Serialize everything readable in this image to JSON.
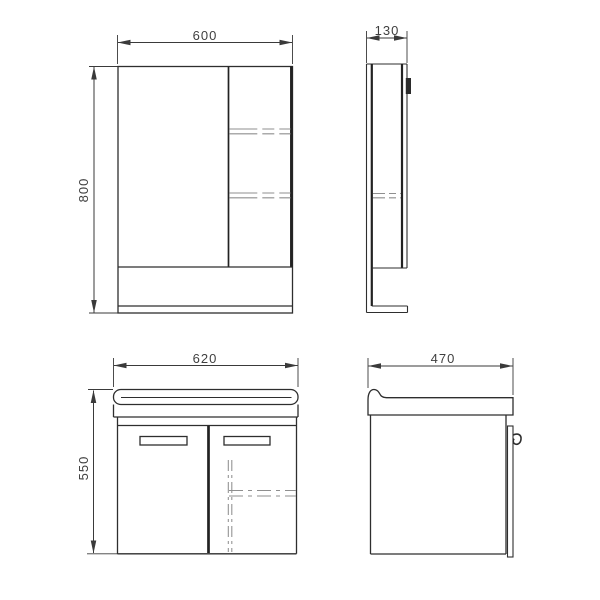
{
  "drawing": {
    "type": "technical-dimension-drawing",
    "units": "mm",
    "colors": {
      "line": "#2e2e2e",
      "hidden_line": "#8f8f8f",
      "dimension": "#3f3f3f",
      "background": "#ffffff"
    },
    "views": {
      "mirror_front": {
        "width_label": "600",
        "height_label": "800"
      },
      "mirror_side": {
        "depth_label": "130"
      },
      "vanity_front": {
        "width_label": "620",
        "height_label": "550"
      },
      "vanity_side": {
        "depth_label": "470"
      }
    }
  }
}
